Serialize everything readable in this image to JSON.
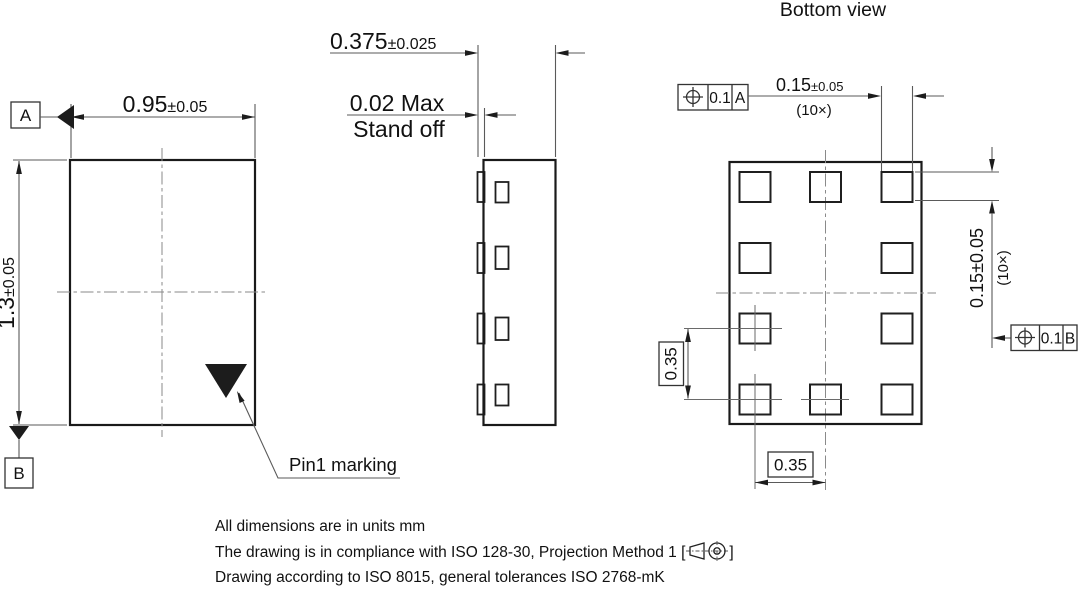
{
  "title": "Bottom view",
  "front_view": {
    "width_dim": {
      "value": "0.95",
      "tol": "±0.05"
    },
    "height_dim": {
      "value": "1.3",
      "tol": "±0.05"
    },
    "datum_a": "A",
    "datum_b": "B",
    "pin1_label": "Pin1 marking"
  },
  "side_view": {
    "thickness_dim": {
      "value": "0.375",
      "tol": "±0.025"
    },
    "standoff": {
      "line1": "0.02 Max",
      "line2": "Stand off"
    }
  },
  "bottom_view": {
    "pad_width_dim": {
      "value": "0.15",
      "tol": "±0.05",
      "count": "(10×)"
    },
    "pad_height_dim": {
      "value": "0.15±0.05",
      "count": "(10×)"
    },
    "pitch_x": "0.35",
    "pitch_y": "0.35",
    "fcf_a": {
      "tolerance": "0.1",
      "datum": "A"
    },
    "fcf_b": {
      "tolerance": "0.1",
      "datum": "B"
    }
  },
  "notes": {
    "line1": "All dimensions are in units mm",
    "line2_prefix": "The drawing is in compliance with ISO 128-30, Projection Method 1 [",
    "line2_suffix": "]",
    "line3": "Drawing according to ISO 8015, general tolerances ISO 2768-mK"
  },
  "colors": {
    "line": "#1a1a1a",
    "thin_line": "#5a5a5a",
    "center_line": "#8a8a8a",
    "background": "#ffffff",
    "text": "#111111"
  }
}
